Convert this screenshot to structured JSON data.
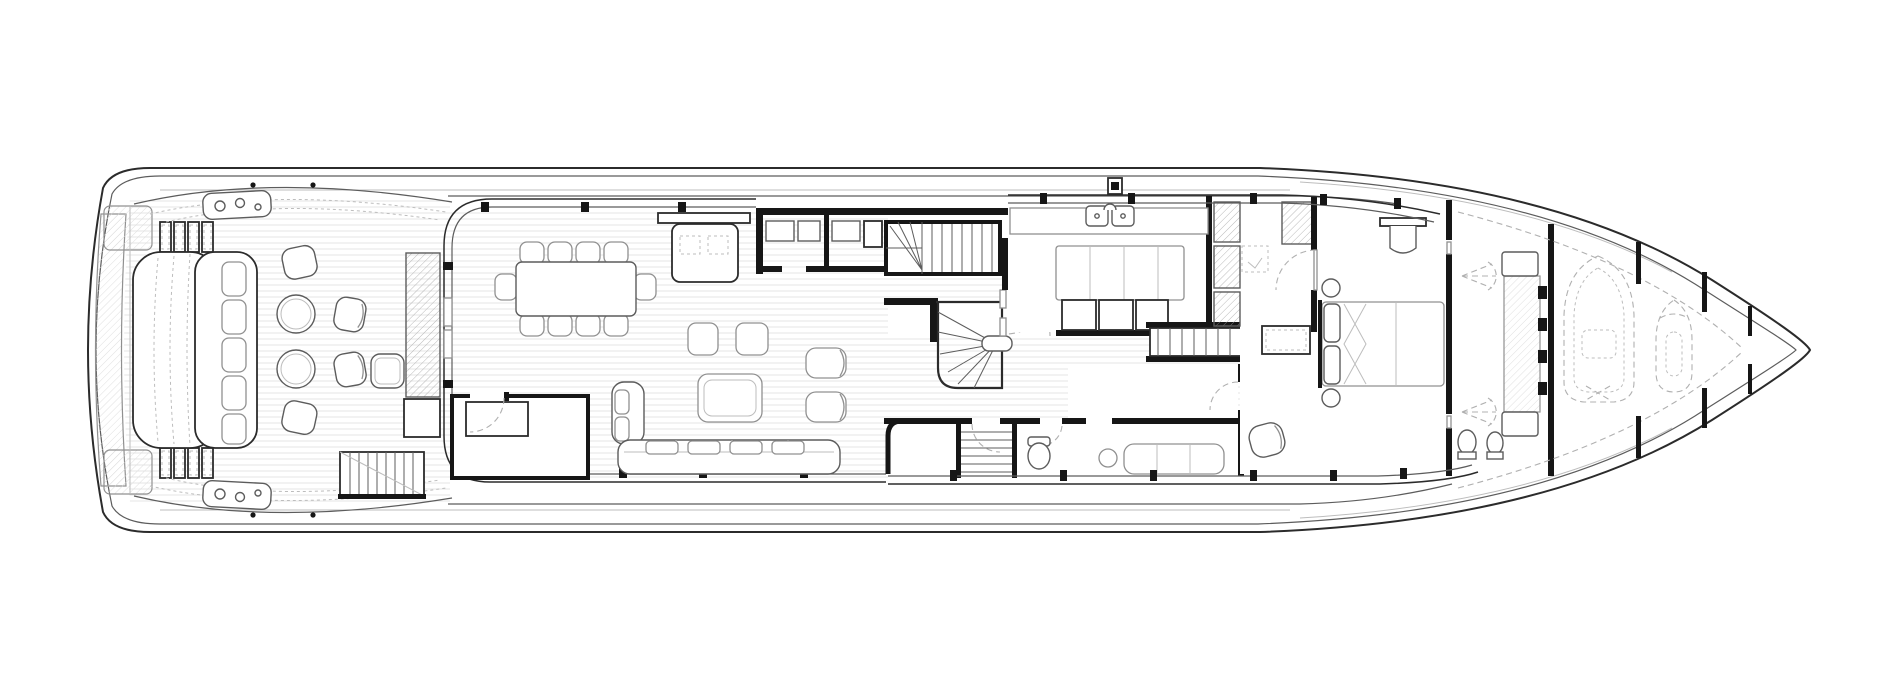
{
  "canvas": {
    "width": 1900,
    "height": 700,
    "background": "#ffffff"
  },
  "colors": {
    "line": "#2b2b2b",
    "wall": "#161616",
    "medium": "#5c5c5c",
    "furniture": "#909090",
    "light": "#bdbdbd",
    "faint": "#dcdcdc",
    "stripe": "#e6e6e6",
    "dash": "#b0b0b0",
    "hatch": "#9c9c9c"
  }
}
